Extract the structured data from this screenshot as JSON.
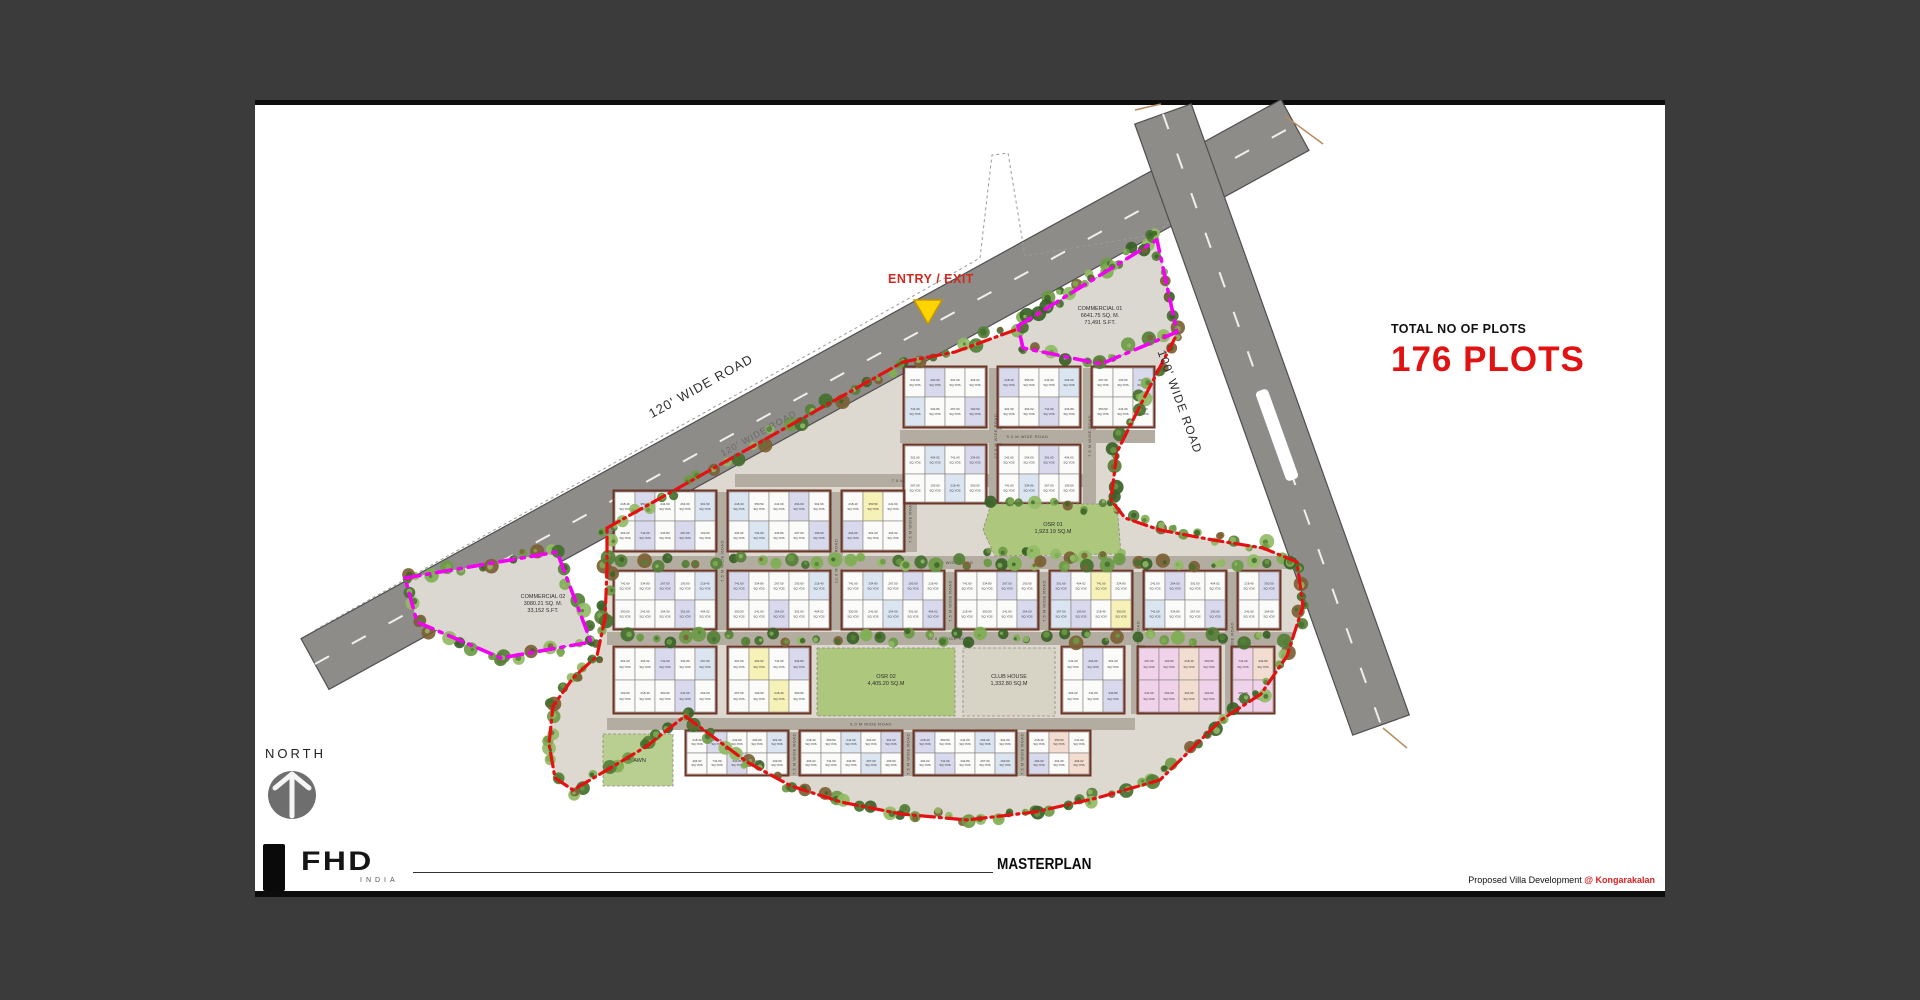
{
  "page": {
    "bg": "#3b3b3b",
    "canvas_bg": "#ffffff"
  },
  "stats": {
    "label": "TOTAL NO OF PLOTS",
    "value": "176 PLOTS",
    "value_color": "#e11212"
  },
  "entry": {
    "label": "ENTRY / EXIT",
    "marker_color": "#ffd500"
  },
  "north": {
    "label": "NORTH"
  },
  "logo": {
    "brand": "FHD",
    "country": "INDIA"
  },
  "footer": {
    "title": "MASTERPLAN",
    "credit": "Proposed Villa Development ",
    "credit_highlight": "@ Kongarakalan"
  },
  "plan": {
    "colors": {
      "ground": "#ddd8d0",
      "road": "#8e8c89",
      "road_edge": "#4f4f4f",
      "inner_road": "#b3aca1",
      "wall": "#6e3426",
      "red": "#e31111",
      "magenta": "#f202f2",
      "commercial": "#dbd8d2",
      "osr": "#adc77d",
      "lawn": "#b9cf92",
      "club": "#d8d4c5",
      "dash": "#f5f5f5",
      "survey": "#9a9a9a",
      "tick": "#b98a5d",
      "plot_fills": {
        "w": "#fbfbfa",
        "lav": "#d9d9ee",
        "blu": "#dbe5f2",
        "pnk": "#f0d3eb",
        "pch": "#f3ddd1",
        "yel": "#f6f1b6"
      },
      "tree_palette": [
        "#44702e",
        "#567f37",
        "#6d9a45",
        "#7fae52",
        "#93bb66",
        "#3a6127",
        "#7c6034"
      ]
    },
    "main_roads": [
      {
        "name": "road-120",
        "label": "120' WIDE ROAD",
        "x1": 60,
        "y1": 564,
        "x2": 1040,
        "y2": 25,
        "width": 58,
        "label_pos": [
          448,
          290
        ],
        "label_angle": -29,
        "label_size": 13,
        "surface_label_pos": [
          505,
          336
        ],
        "surface_label_angle": -29
      },
      {
        "name": "road-100",
        "label": "100' WIDE ROAD",
        "x1": 908,
        "y1": 14,
        "x2": 1126,
        "y2": 625,
        "width": 60,
        "label_pos": [
          921,
          303
        ],
        "label_angle": 70,
        "label_size": 12,
        "surface_label_pos": null,
        "surface_label_angle": 0
      }
    ],
    "median": {
      "cx": 1022,
      "cy": 335,
      "length": 95,
      "width": 13,
      "angle": 70.3
    },
    "survey_line": [
      60,
      530,
      660,
      195,
      725,
      158,
      737,
      55,
      753,
      53,
      770,
      156,
      902,
      134,
      916,
      120
    ],
    "ticks": [
      [
        1030,
        16,
        1068,
        44
      ],
      [
        880,
        10,
        906,
        4
      ],
      [
        1128,
        628,
        1152,
        648
      ]
    ],
    "internal_road_labels": [
      "7.5 M WIDE ROAD",
      "9.0 M WIDE ROAD",
      "12.0 M WIDE ROAD",
      "13.5 M WIDE ROAD"
    ],
    "ground_pts": "352,428 648,262 700,252 760,230 763,226 902,140 922,232 920,238 888,300 862,352 856,400 870,418 905,430 958,440 1008,448 1042,462 1048,506 1032,556 1006,594 966,620 905,680 842,698 780,712 712,720 646,714 586,702 536,686 492,662 430,616 392,646 352,670 318,690 300,678 294,644 298,606 318,578 342,556 350,518 352,470",
    "red_paths": [
      "M352,428 L648,262 L700,252 L760,230",
      "M920,238 L888,300 L862,352 L856,400 L870,418 L905,430 L958,440 L1008,448 L1042,462 L1048,506 L1032,556 L1006,594 L966,620 L905,680 L842,698 L780,712 L712,720 L646,714 L586,702 L536,686 L492,662 L430,616 L392,646 L352,670 L318,690 L300,678 L294,644 L298,606 L318,578 L342,556 L350,518 L352,470 L352,428"
    ],
    "magenta_polys": [
      "763,226 902,140 922,232 846,264 768,248",
      "150,478 302,452 336,542 246,558 162,522"
    ],
    "areas": [
      {
        "name": "area-commercial-01",
        "type": "poly",
        "pts": "763,226 902,140 922,232 846,264 768,248",
        "fill": "commercial",
        "lines": [
          "COMMERCIAL 01",
          "6641.75 SQ. M.",
          "71,491 S.FT."
        ],
        "label": [
          845,
          210
        ]
      },
      {
        "name": "area-commercial-02",
        "type": "poly",
        "pts": "150,478 302,452 336,542 246,558 162,522",
        "fill": "commercial",
        "lines": [
          "COMMERCIAL 02",
          "3080.21 SQ. M.",
          "33,152 S.FT."
        ],
        "label": [
          288,
          498
        ]
      },
      {
        "name": "area-osr-01",
        "type": "poly",
        "pts": "736,404 862,404 866,454 740,456 728,430",
        "fill": "osr",
        "lines": [
          "OSR 01",
          "1,923.19 SQ.M"
        ],
        "label": [
          798,
          426
        ]
      },
      {
        "name": "area-osr-02",
        "type": "rect",
        "x": 562,
        "y": 548,
        "w": 138,
        "h": 68,
        "fill": "osr",
        "lines": [
          "OSR 02",
          "4,405.20 SQ.M"
        ],
        "label": [
          631,
          578
        ]
      },
      {
        "name": "area-club-house",
        "type": "rect",
        "x": 708,
        "y": 548,
        "w": 92,
        "h": 68,
        "fill": "club",
        "lines": [
          "CLUB HOUSE",
          "1,332.80 SQ.M"
        ],
        "label": [
          754,
          578
        ]
      },
      {
        "name": "area-lawn",
        "type": "rect",
        "x": 348,
        "y": 634,
        "w": 70,
        "h": 52,
        "fill": "lawn",
        "lines": [
          "LAWN"
        ],
        "label": [
          383,
          662
        ]
      }
    ],
    "h_roads": [
      {
        "x": 645,
        "y": 330,
        "w": 255,
        "h": 13,
        "label_idx": 1
      },
      {
        "x": 480,
        "y": 374,
        "w": 355,
        "h": 13,
        "label_idx": 0
      },
      {
        "x": 352,
        "y": 456,
        "w": 688,
        "h": 13,
        "label_idx": 3
      },
      {
        "x": 352,
        "y": 532,
        "w": 686,
        "h": 13,
        "label_idx": 2
      },
      {
        "x": 352,
        "y": 618,
        "w": 528,
        "h": 12,
        "label_idx": 1
      }
    ],
    "v_roads": [
      {
        "x": 734,
        "y": 268,
        "w": 13,
        "h": 136,
        "label_idx": 2
      },
      {
        "x": 828,
        "y": 268,
        "w": 13,
        "h": 136,
        "label_idx": 0
      },
      {
        "x": 460,
        "y": 392,
        "w": 14,
        "h": 138,
        "label_idx": 0
      },
      {
        "x": 574,
        "y": 392,
        "w": 14,
        "h": 138,
        "label_idx": 2
      },
      {
        "x": 648,
        "y": 392,
        "w": 14,
        "h": 60,
        "label_idx": 0
      },
      {
        "x": 688,
        "y": 472,
        "w": 14,
        "h": 58,
        "label_idx": 0
      },
      {
        "x": 782,
        "y": 472,
        "w": 14,
        "h": 58,
        "label_idx": 0
      },
      {
        "x": 876,
        "y": 472,
        "w": 14,
        "h": 142,
        "label_idx": 2
      },
      {
        "x": 970,
        "y": 472,
        "w": 14,
        "h": 142,
        "label_idx": 0
      },
      {
        "x": 532,
        "y": 632,
        "w": 14,
        "h": 44,
        "label_idx": 0
      },
      {
        "x": 646,
        "y": 632,
        "w": 14,
        "h": 44,
        "label_idx": 0
      },
      {
        "x": 760,
        "y": 632,
        "w": 14,
        "h": 44,
        "label_idx": 0
      }
    ],
    "blocks": [
      {
        "x": 650,
        "y": 268,
        "cols": 4,
        "rows": 2,
        "pw": 20,
        "ph": 29,
        "fills": [
          "w",
          "lav",
          "w",
          "w",
          "blu",
          "w"
        ]
      },
      {
        "x": 744,
        "y": 268,
        "cols": 4,
        "rows": 2,
        "pw": 20,
        "ph": 29,
        "fills": [
          "lav",
          "w",
          "w",
          "blu",
          "w",
          "w"
        ]
      },
      {
        "x": 838,
        "y": 268,
        "cols": 3,
        "rows": 2,
        "pw": 20,
        "ph": 29,
        "fills": [
          "w",
          "w",
          "lav",
          "w"
        ]
      },
      {
        "x": 650,
        "y": 346,
        "cols": 4,
        "rows": 2,
        "pw": 20,
        "ph": 28,
        "fills": [
          "w",
          "blu",
          "w",
          "lav",
          "w"
        ]
      },
      {
        "x": 744,
        "y": 346,
        "cols": 4,
        "rows": 2,
        "pw": 20,
        "ph": 28,
        "fills": [
          "w",
          "w",
          "lav",
          "w",
          "w",
          "blu"
        ]
      },
      {
        "x": 360,
        "y": 392,
        "cols": 5,
        "rows": 2,
        "pw": 20,
        "ph": 29,
        "fills": [
          "w",
          "lav",
          "w",
          "w",
          "blu",
          "w",
          "lav"
        ]
      },
      {
        "x": 474,
        "y": 392,
        "cols": 5,
        "rows": 2,
        "pw": 20,
        "ph": 29,
        "fills": [
          "blu",
          "w",
          "w",
          "lav",
          "w",
          "w"
        ]
      },
      {
        "x": 588,
        "y": 392,
        "cols": 3,
        "rows": 2,
        "pw": 20,
        "ph": 29,
        "fills": [
          "w",
          "yel",
          "w",
          "lav",
          "w",
          "w"
        ]
      },
      {
        "x": 360,
        "y": 472,
        "cols": 5,
        "rows": 2,
        "pw": 20,
        "ph": 28,
        "fills": [
          "w",
          "w",
          "lav",
          "w",
          "blu",
          "w"
        ]
      },
      {
        "x": 474,
        "y": 472,
        "cols": 5,
        "rows": 2,
        "pw": 20,
        "ph": 28,
        "fills": [
          "lav",
          "w",
          "w",
          "w",
          "blu",
          "w",
          "w"
        ]
      },
      {
        "x": 588,
        "y": 472,
        "cols": 5,
        "rows": 2,
        "pw": 20,
        "ph": 28,
        "fills": [
          "w",
          "blu",
          "w",
          "lav",
          "w",
          "w"
        ]
      },
      {
        "x": 702,
        "y": 472,
        "cols": 4,
        "rows": 2,
        "pw": 20,
        "ph": 28,
        "fills": [
          "w",
          "w",
          "lav",
          "w",
          "w"
        ]
      },
      {
        "x": 796,
        "y": 472,
        "cols": 4,
        "rows": 2,
        "pw": 20,
        "ph": 28,
        "fills": [
          "lav",
          "w",
          "yel",
          "w",
          "blu"
        ]
      },
      {
        "x": 890,
        "y": 472,
        "cols": 4,
        "rows": 2,
        "pw": 20,
        "ph": 28,
        "fills": [
          "w",
          "lav",
          "w",
          "w",
          "blu",
          "w"
        ]
      },
      {
        "x": 984,
        "y": 472,
        "cols": 2,
        "rows": 2,
        "pw": 20,
        "ph": 28,
        "fills": [
          "w",
          "lav",
          "w"
        ]
      },
      {
        "x": 360,
        "y": 548,
        "cols": 5,
        "rows": 2,
        "pw": 20,
        "ph": 32,
        "fills": [
          "w",
          "w",
          "lav",
          "w",
          "blu",
          "w"
        ]
      },
      {
        "x": 474,
        "y": 548,
        "cols": 4,
        "rows": 2,
        "pw": 20,
        "ph": 32,
        "fills": [
          "w",
          "yel",
          "w",
          "lav",
          "w"
        ]
      },
      {
        "x": 808,
        "y": 548,
        "cols": 3,
        "rows": 2,
        "pw": 20,
        "ph": 32,
        "fills": [
          "w",
          "lav",
          "w",
          "w"
        ]
      },
      {
        "x": 884,
        "y": 548,
        "cols": 4,
        "rows": 2,
        "pw": 20,
        "ph": 32,
        "fills": [
          "pnk",
          "pnk",
          "pch",
          "pnk"
        ]
      },
      {
        "x": 978,
        "y": 548,
        "cols": 2,
        "rows": 2,
        "pw": 20,
        "ph": 32,
        "fills": [
          "pnk",
          "pch",
          "pnk"
        ]
      },
      {
        "x": 432,
        "y": 632,
        "cols": 5,
        "rows": 2,
        "pw": 20,
        "ph": 21,
        "fills": [
          "w",
          "lav",
          "w",
          "w",
          "blu",
          "w"
        ]
      },
      {
        "x": 546,
        "y": 632,
        "cols": 5,
        "rows": 2,
        "pw": 20,
        "ph": 21,
        "fills": [
          "w",
          "w",
          "blu",
          "w",
          "lav",
          "w"
        ]
      },
      {
        "x": 660,
        "y": 632,
        "cols": 5,
        "rows": 2,
        "pw": 20,
        "ph": 21,
        "fills": [
          "lav",
          "w",
          "w",
          "blu",
          "w",
          "w"
        ]
      },
      {
        "x": 774,
        "y": 632,
        "cols": 3,
        "rows": 2,
        "pw": 20,
        "ph": 21,
        "fills": [
          "w",
          "pch",
          "w",
          "lav"
        ]
      }
    ],
    "plot_area_samples": [
      "241.60",
      "264.00",
      "301.60",
      "404.02",
      "741.60",
      "334.80",
      "267.00",
      "193.60",
      "218.40",
      "350.50"
    ],
    "plot_unit": "SQ.YDS",
    "entry_triangle": "659,200 687,200 673,224",
    "tree_lines": [
      [
        352,
        428,
        648,
        262,
        760,
        228
      ],
      [
        768,
        218,
        902,
        136
      ],
      [
        920,
        240,
        888,
        300,
        862,
        352,
        856,
        400
      ],
      [
        860,
        405,
        905,
        428,
        960,
        438,
        1010,
        446,
        1040,
        462
      ],
      [
        1046,
        470,
        1048,
        508,
        1032,
        556,
        1006,
        594,
        968,
        620
      ],
      [
        962,
        624,
        900,
        680,
        840,
        698,
        780,
        712,
        712,
        720,
        646,
        714,
        586,
        702,
        536,
        686,
        492,
        662,
        456,
        636,
        430,
        616
      ],
      [
        426,
        618,
        390,
        646,
        350,
        670,
        316,
        690,
        300,
        678,
        294,
        644,
        298,
        606,
        318,
        578,
        342,
        558,
        350,
        520,
        352,
        470,
        356,
        428
      ],
      [
        150,
        478,
        300,
        452,
        336,
        542,
        248,
        558,
        162,
        522,
        150,
        478
      ],
      [
        763,
        224,
        900,
        138,
        922,
        230,
        846,
        262,
        766,
        246
      ],
      [
        736,
        406,
        862,
        406
      ],
      [
        736,
        454,
        862,
        454
      ],
      [
        370,
        462,
        1030,
        462
      ],
      [
        370,
        538,
        1030,
        538
      ]
    ]
  }
}
